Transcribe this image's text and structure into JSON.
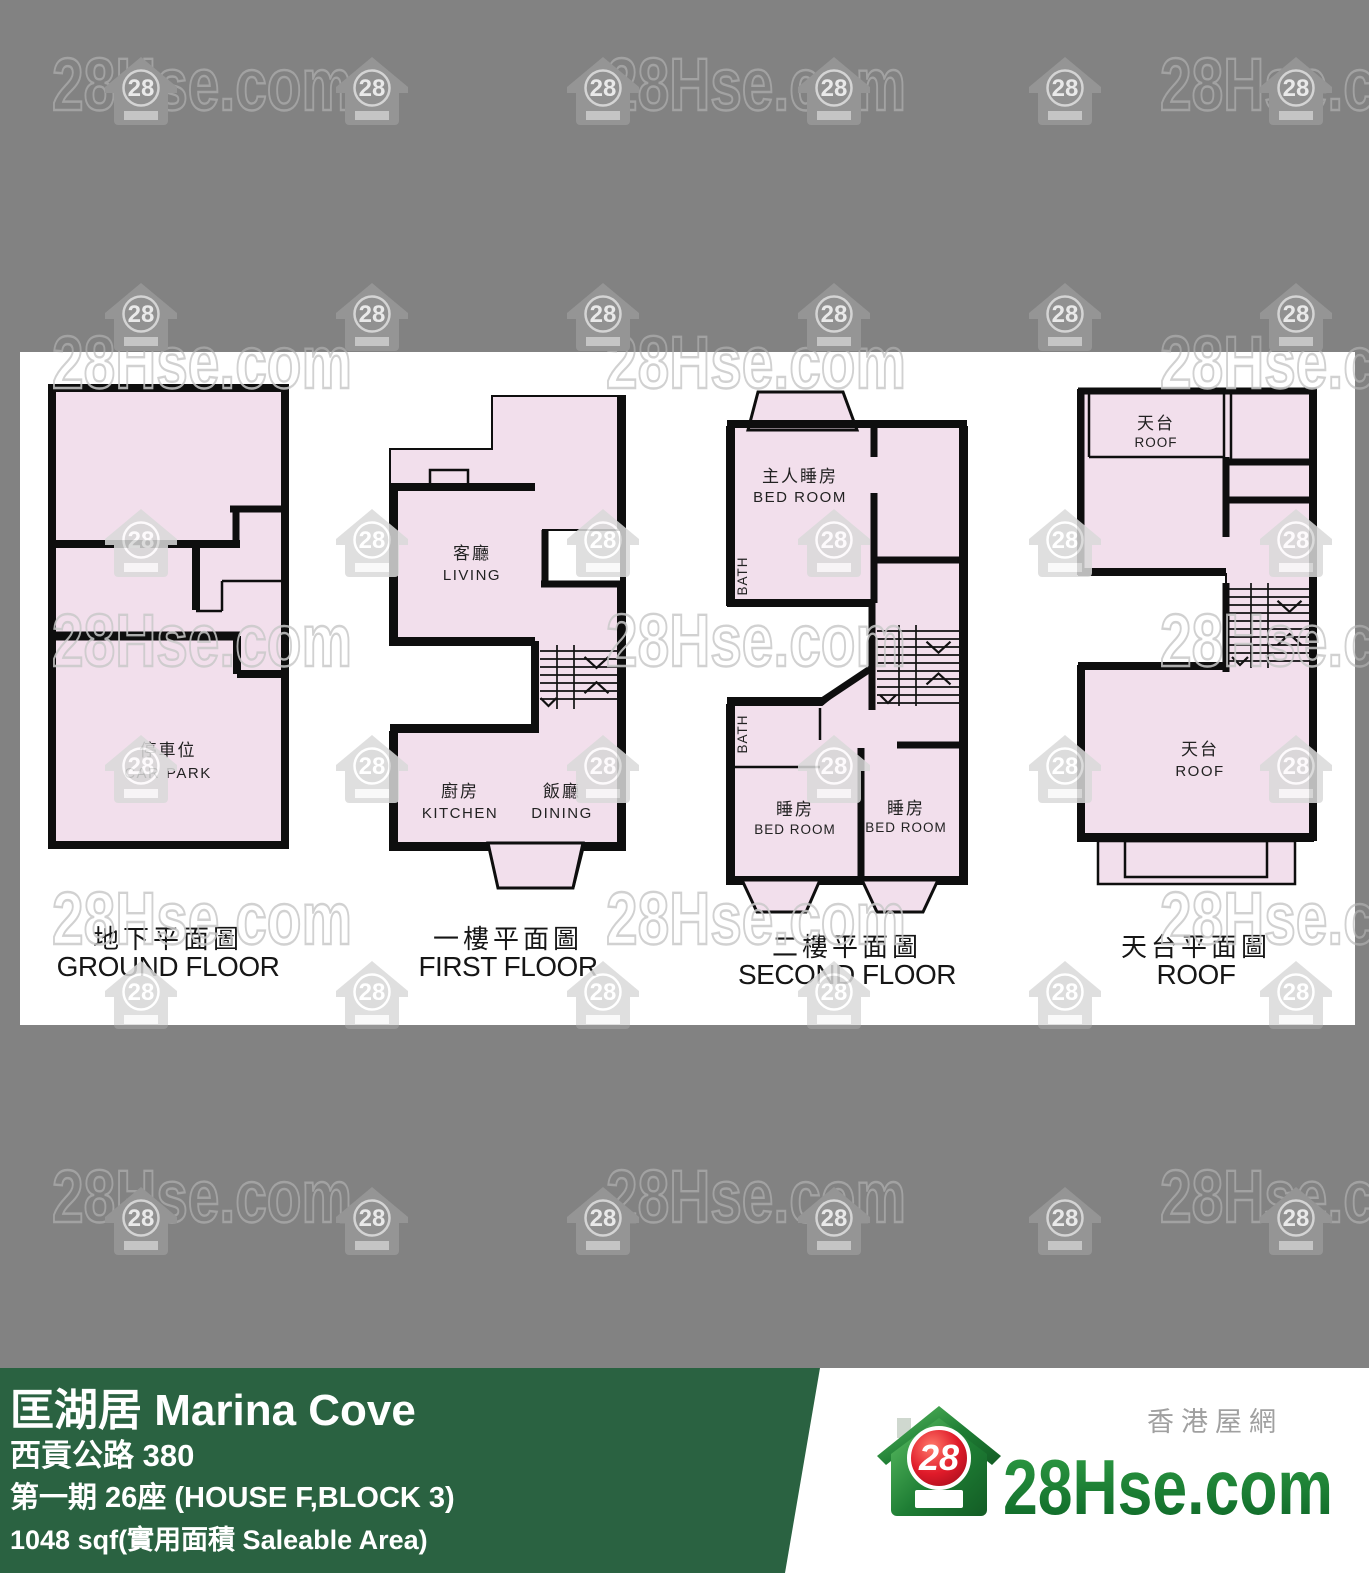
{
  "watermark": {
    "site": "28Hse.com",
    "badge": "28"
  },
  "plans": [
    {
      "caption_zh": "地下平面圖",
      "caption_en": "GROUND FLOOR",
      "rooms": [
        {
          "zh": "停車位",
          "en": "CAR PARK"
        }
      ]
    },
    {
      "caption_zh": "一樓平面圖",
      "caption_en": "FIRST FLOOR",
      "rooms": [
        {
          "zh": "客廳",
          "en": "LIVING"
        },
        {
          "zh": "廚房",
          "en": "KITCHEN"
        },
        {
          "zh": "飯廳",
          "en": "DINING"
        }
      ]
    },
    {
      "caption_zh": "二樓平面圖",
      "caption_en": "SECOND FLOOR",
      "rooms": [
        {
          "zh": "主人睡房",
          "en": "BED ROOM"
        },
        {
          "en": "BATH"
        },
        {
          "en": "BATH"
        },
        {
          "zh": "睡房",
          "en": "BED ROOM"
        },
        {
          "zh": "睡房",
          "en": "BED ROOM"
        }
      ]
    },
    {
      "caption_zh": "天台平面圖",
      "caption_en": "ROOF",
      "rooms": [
        {
          "zh": "天台",
          "en": "ROOF"
        },
        {
          "zh": "天台",
          "en": "ROOF"
        }
      ]
    }
  ],
  "footer": {
    "title": "匡湖居 Marina Cove",
    "address": "西貢公路 380",
    "block": "第一期 26座 (HOUSE F,BLOCK 3)",
    "area": "1048 sqf(實用面積 Saleable Area)"
  },
  "logo": {
    "tagline_zh": "香港屋網",
    "brand": "28Hse.com",
    "badge": "28"
  },
  "colors": {
    "background": "#828282",
    "floor_fill": "#f2dfec",
    "wall": "#0e0e0e",
    "banner_green": "#2a6241",
    "brand_green": "#1d8c38",
    "badge_red": "#d21425"
  }
}
